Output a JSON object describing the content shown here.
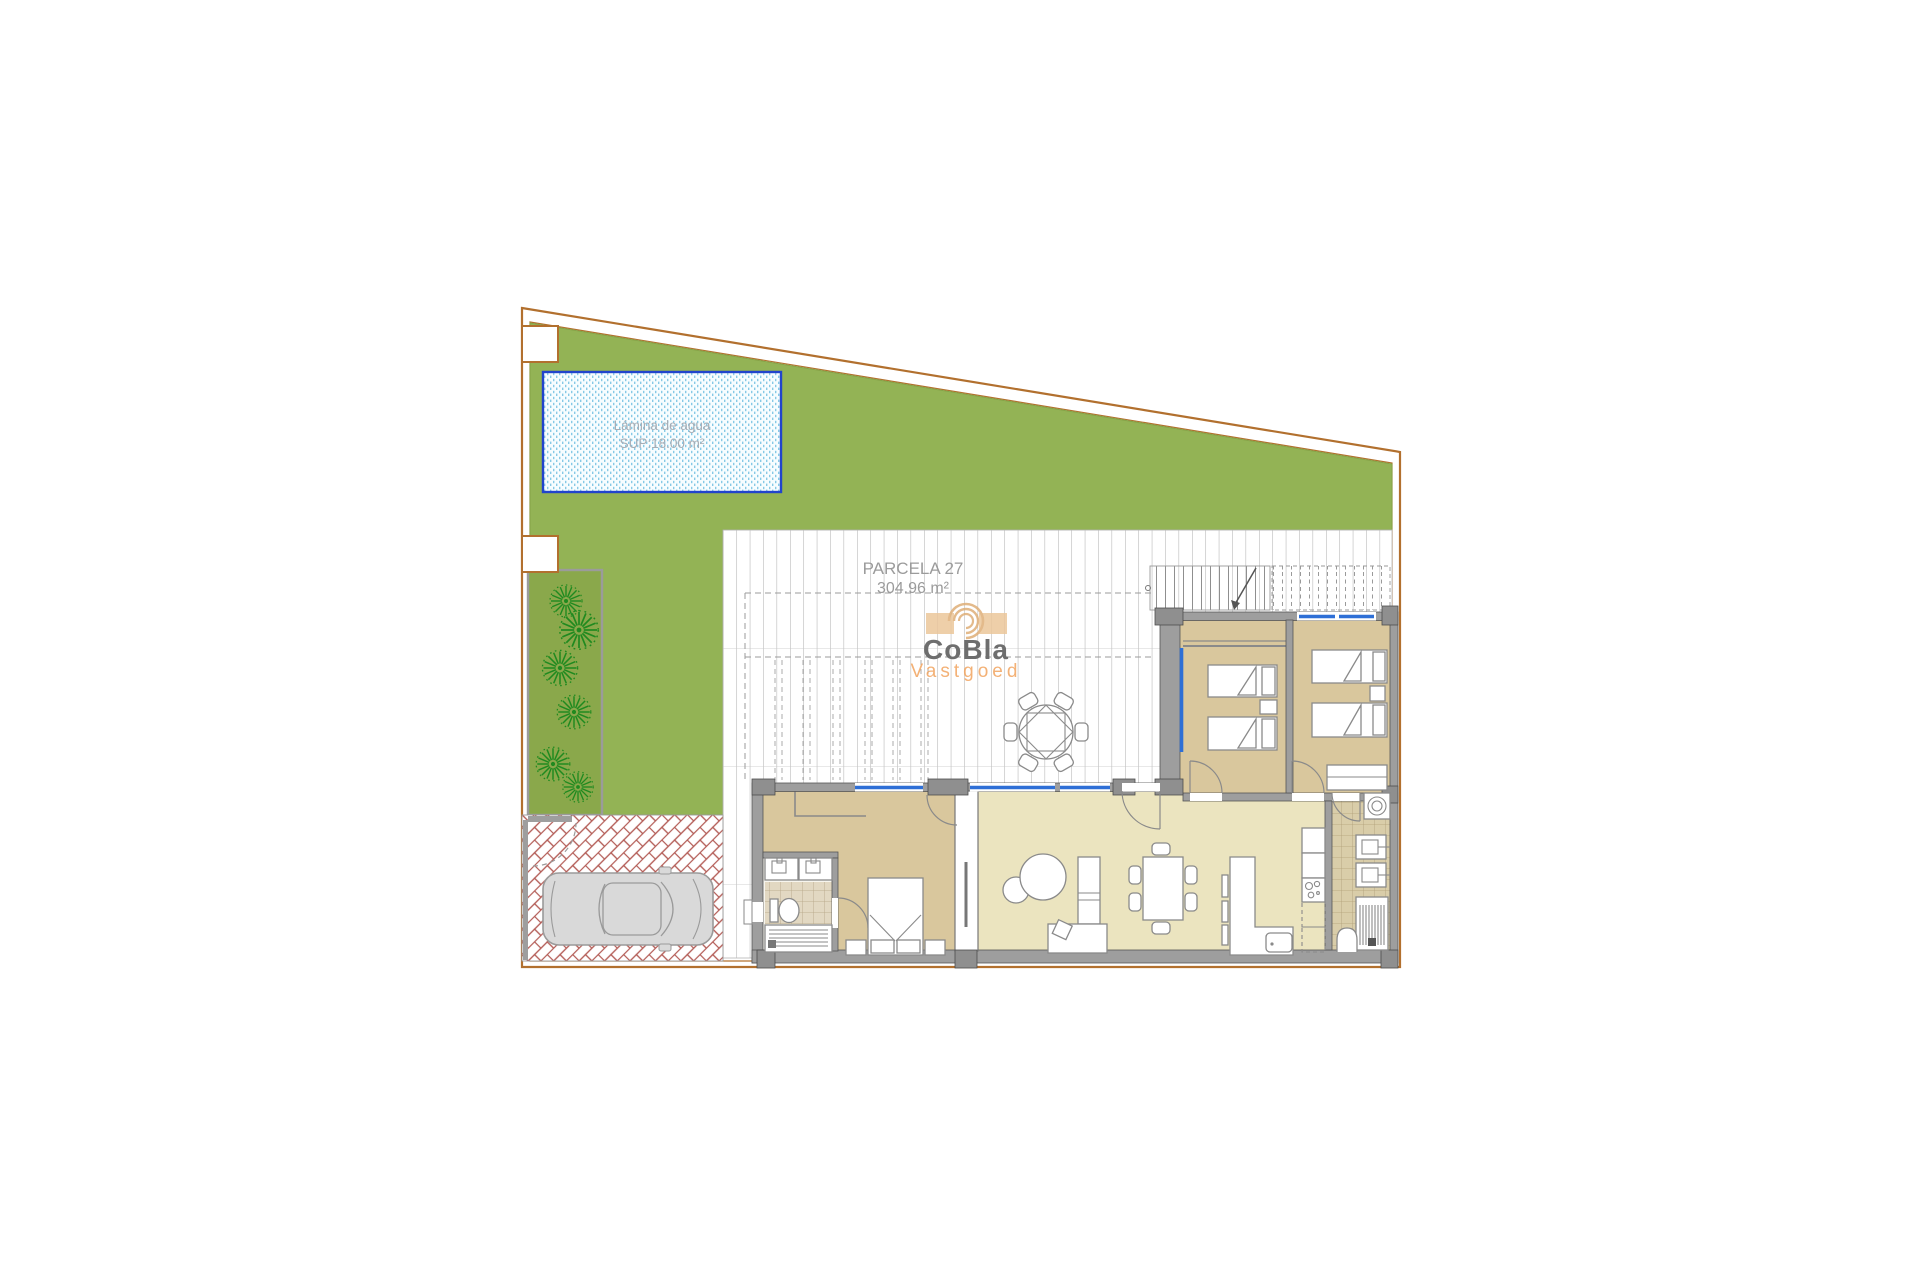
{
  "labels": {
    "parcel_name": "PARCELA 27",
    "parcel_area": "304.96 m²",
    "pool_title": "Lámina de agua",
    "pool_area": "SUP:18.00 m²"
  },
  "logo": {
    "name": "CoBla",
    "subtitle": "Vastgoed",
    "icon": "spiral-arcs-icon",
    "name_color": "#6e6e6e",
    "subtitle_color": "#f2a45f",
    "icon_color": "#e4b583"
  },
  "colors": {
    "plot_boundary": "#b2702e",
    "lawn": "#93b355",
    "garden_strip": "#8aa84b",
    "tree": "#1f8a1f",
    "pool_border": "#2244cc",
    "pool_water": "#f7fdff",
    "pool_dots": "#86c9e6",
    "terrace_tile_line": "#adadad",
    "paving_herringbone": "#b35b55",
    "wall": "#9e9e9e",
    "window": "#2e6fd6",
    "bedroom_floor": "#d9c79d",
    "living_floor": "#ebe4bf",
    "utility_floor": "#d9cda9",
    "car_body": "#d9d9d9"
  },
  "features": [
    "plot-boundary",
    "lawn",
    "swimming-pool",
    "garden-strip",
    "trees",
    "driveway-herringbone",
    "car",
    "terrace-tiled",
    "pergola-dashed",
    "external-staircase",
    "house",
    "master-bedroom",
    "bathroom",
    "living-dining-room",
    "kitchen",
    "utility-room",
    "bedroom-1",
    "bedroom-2",
    "outdoor-round-table",
    "utility-meter-boxes"
  ]
}
